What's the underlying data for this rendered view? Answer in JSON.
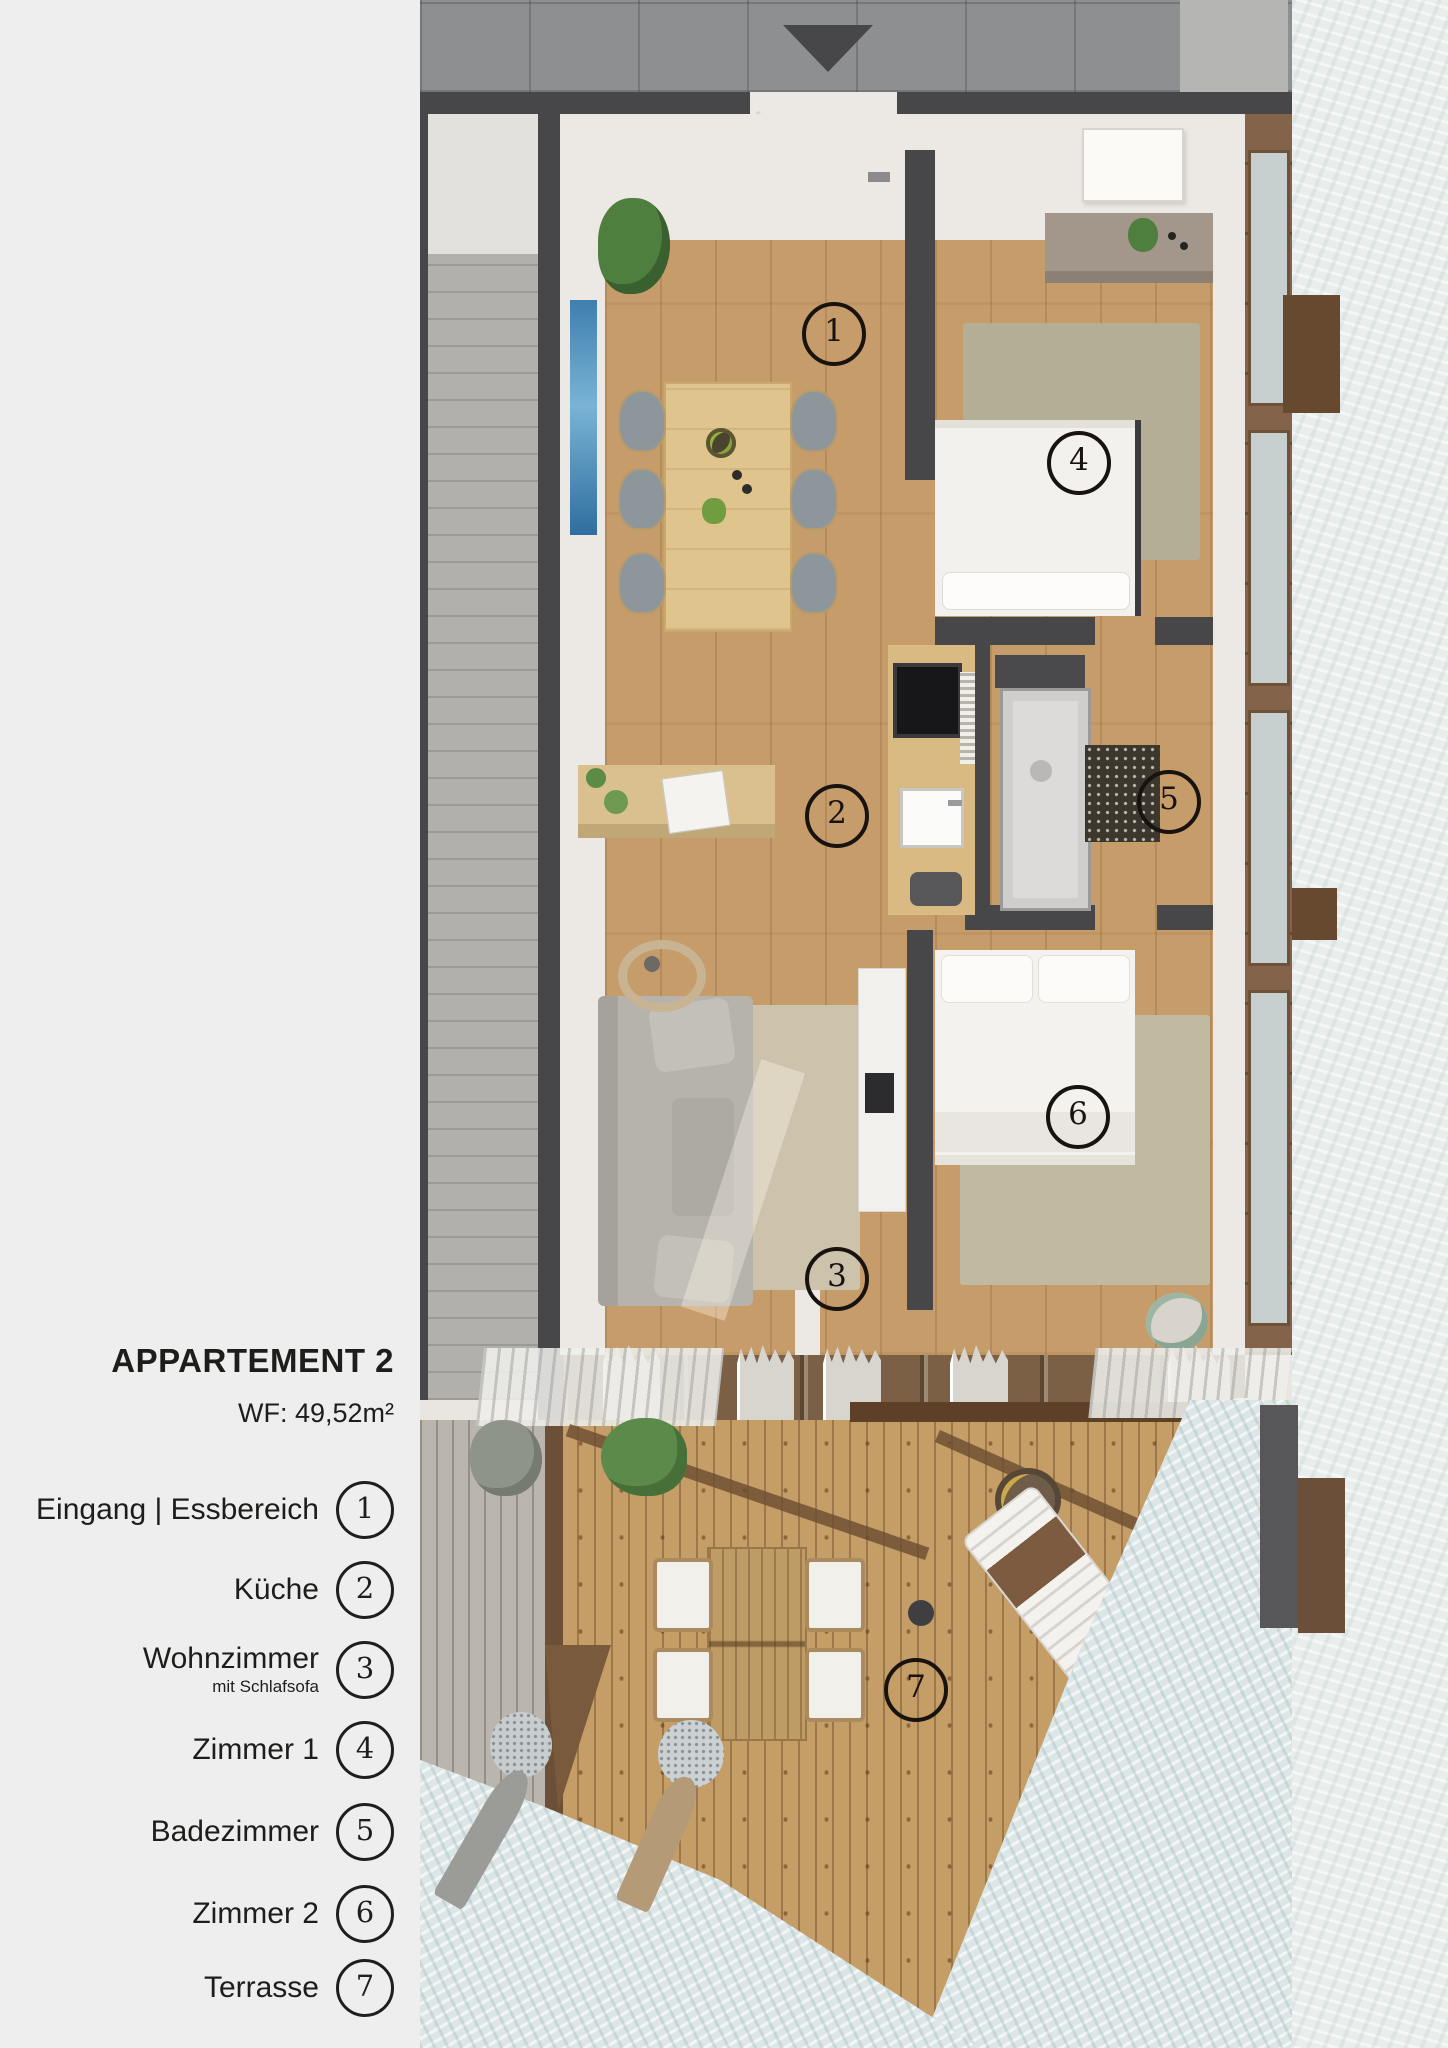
{
  "sidebar": {
    "title": "APPARTEMENT 2",
    "area_label": "WF: 49,52m²",
    "legend": [
      {
        "number": "1",
        "label": "Eingang | Essbereich",
        "sub": ""
      },
      {
        "number": "2",
        "label": "Küche",
        "sub": ""
      },
      {
        "number": "3",
        "label": "Wohnzimmer",
        "sub": "mit Schlafsofa"
      },
      {
        "number": "4",
        "label": "Zimmer 1",
        "sub": ""
      },
      {
        "number": "5",
        "label": "Badezimmer",
        "sub": ""
      },
      {
        "number": "6",
        "label": "Zimmer 2",
        "sub": ""
      },
      {
        "number": "7",
        "label": "Terrasse",
        "sub": ""
      }
    ]
  },
  "plan": {
    "markers": [
      {
        "number": "1",
        "room": "Eingang | Essbereich"
      },
      {
        "number": "2",
        "room": "Küche"
      },
      {
        "number": "3",
        "room": "Wohnzimmer mit Schlafsofa"
      },
      {
        "number": "4",
        "room": "Zimmer 1"
      },
      {
        "number": "5",
        "room": "Badezimmer"
      },
      {
        "number": "6",
        "room": "Zimmer 2"
      },
      {
        "number": "7",
        "room": "Terrasse"
      }
    ],
    "entrance_arrow": "entry from corridor, pointing down"
  },
  "colors": {
    "sidebar_bg": "#eeeeee",
    "text": "#1d1d1b",
    "wall_dark": "#47474a",
    "corridor_tile": "#8e8f90",
    "wood_floor": "#c79c6b",
    "neighbor_wood": "#b2b0ad",
    "deck_wood": "#c59d66",
    "window_frame": "#83644a",
    "snow": "#e9edec",
    "rug": "#c1b9a2",
    "plant_green": "#5c8a4a"
  }
}
